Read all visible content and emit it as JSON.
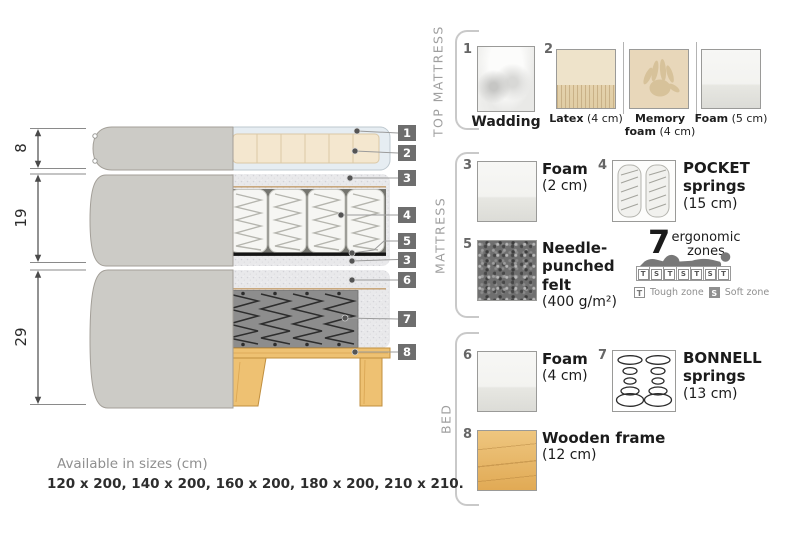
{
  "diagram": {
    "dims": [
      "8",
      "19",
      "29"
    ],
    "callouts": [
      "1",
      "2",
      "3",
      "4",
      "5",
      "3",
      "6",
      "7",
      "8"
    ]
  },
  "legend": {
    "top": {
      "title": "TOP MATTRESS",
      "wadding": {
        "num": "1",
        "name": "Wadding"
      },
      "latex": {
        "num": "2",
        "name": "Latex",
        "size": "(4 cm)"
      },
      "memory": {
        "name_l1": "Memory",
        "name_l2": "foam",
        "size": "(4 cm)"
      },
      "foam": {
        "name": "Foam",
        "size": "(5 cm)"
      }
    },
    "mattress": {
      "title": "MATTRESS",
      "foam": {
        "num": "3",
        "name": "Foam",
        "size": "(2 cm)"
      },
      "pocket": {
        "num": "4",
        "name_l1": "POCKET",
        "name_l2": "springs",
        "size": "(15 cm)"
      },
      "felt": {
        "num": "5",
        "name_l1": "Needle-",
        "name_l2": "punched",
        "name_l3": "felt",
        "size": "(400 g/m²)"
      },
      "ergonomic": {
        "count": "7",
        "label_l1": "ergonomic",
        "label_l2": "zones",
        "zones": [
          "T",
          "S",
          "T",
          "S",
          "T",
          "S",
          "T"
        ],
        "tough_key": "T",
        "tough_label": "Tough zone",
        "soft_key": "S",
        "soft_label": "Soft zone"
      }
    },
    "bed": {
      "title": "BED",
      "foam": {
        "num": "6",
        "name": "Foam",
        "size": "(4 cm)"
      },
      "bonnell": {
        "num": "7",
        "name_l1": "BONNELL",
        "name_l2": "springs",
        "size": "(13 cm)"
      },
      "frame": {
        "num": "8",
        "name": "Wooden frame",
        "size": "(12 cm)"
      }
    }
  },
  "footer": {
    "heading": "Available in sizes (cm)",
    "values": "120 x 200, 140 x 200, 160 x 200, 180 x 200, 210 x 210."
  }
}
